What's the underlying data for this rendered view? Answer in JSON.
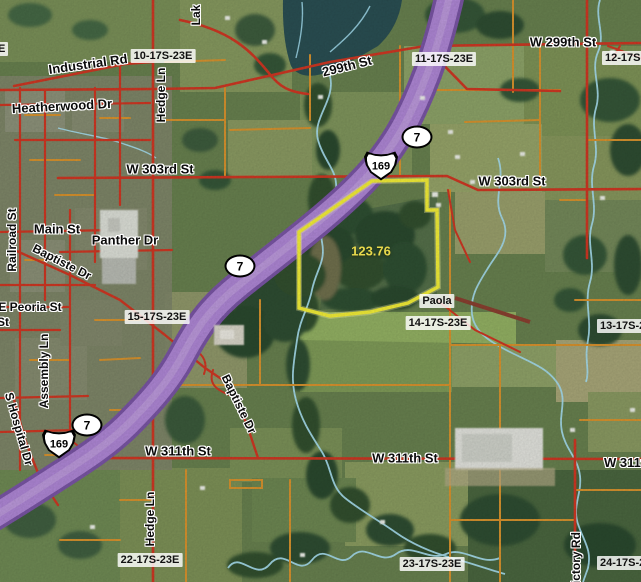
{
  "map": {
    "city_label": "Paola",
    "parcel": {
      "area_label": "123.76"
    },
    "shields": {
      "state_route_7": "7",
      "us_route_169": "169"
    },
    "colors": {
      "parcel_boundary": "#f4ef38",
      "highway_fill": "#af87d6",
      "major_road": "#cf3723",
      "minor_road": "#d8932e",
      "stream": "#a5dcec",
      "area_text": "#e8d94c"
    },
    "streets": {
      "industrial_rd": "Industrial Rd",
      "heatherwood_dr": "Heatherwood Dr",
      "hedge_ln_top": "Hedge Ln",
      "lake_ln_partial": "Lak",
      "st_299_diag": "299th St",
      "w_299th_st": "W 299th St",
      "w_303rd_st_w": "W 303rd St",
      "w_303rd_st_e": "W 303rd St",
      "main_st": "Main St",
      "panther_dr": "Panther Dr",
      "baptiste_dr_n": "Baptiste Dr",
      "railroad_st": "Railroad St",
      "e_peoria_st": "E Peoria St",
      "st_partial": "St",
      "assembly_ln": "Assembly Ln",
      "s_hospital_dr": "S Hospital Dr",
      "w_311th_st_w": "W 311th St",
      "w_311th_st_c": "W 311th St",
      "w_311th_st_e": "W 311th St",
      "hedge_ln_s": "Hedge Ln",
      "baptiste_dr_s": "Baptiste Dr",
      "victory_rd": "Victory Rd"
    },
    "sections": {
      "s9_partial": "E",
      "s10": "10-17S-23E",
      "s11": "11-17S-23E",
      "s12": "12-17S-23E",
      "s13": "13-17S-23E",
      "s14": "14-17S-23E",
      "s15": "15-17S-23E",
      "s22": "22-17S-23E",
      "s23": "23-17S-23E",
      "s24": "24-17S-23E"
    }
  }
}
